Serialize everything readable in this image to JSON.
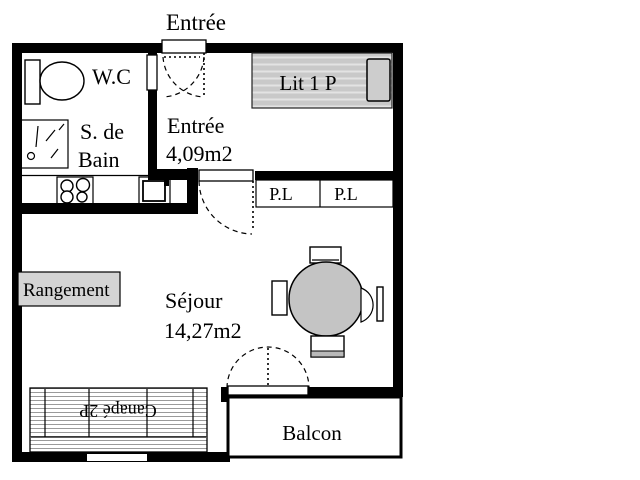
{
  "plan_title": "Entrée",
  "rooms": {
    "wc": {
      "label": "W.C"
    },
    "bathroom": {
      "label_line1": "S. de",
      "label_line2": "Bain"
    },
    "hall": {
      "label": "Entrée",
      "area": "4,09m2"
    },
    "bedroom": {
      "bed_label": "Lit 1 P"
    },
    "closets": {
      "left_label": "P.L",
      "right_label": "P.L"
    },
    "living_room": {
      "label": "Séjour",
      "area": "14,27m2"
    },
    "storage": {
      "label": "Rangement"
    },
    "balcony": {
      "label": "Balcon"
    }
  },
  "furniture": {
    "sofa_label": "Canapé 2P"
  },
  "colors": {
    "wall": "#000000",
    "bed_fill": "#c9c9c9",
    "bed_stripe": "#e3e3e3",
    "pillow_fill": "#cdcdcd",
    "table_fill": "#c4c4c4",
    "storage_fill": "#d4d4d4",
    "sofa_stripe": "#9a9a9a",
    "chair_bar_fill": "#b9b9b9",
    "background": "#ffffff"
  }
}
